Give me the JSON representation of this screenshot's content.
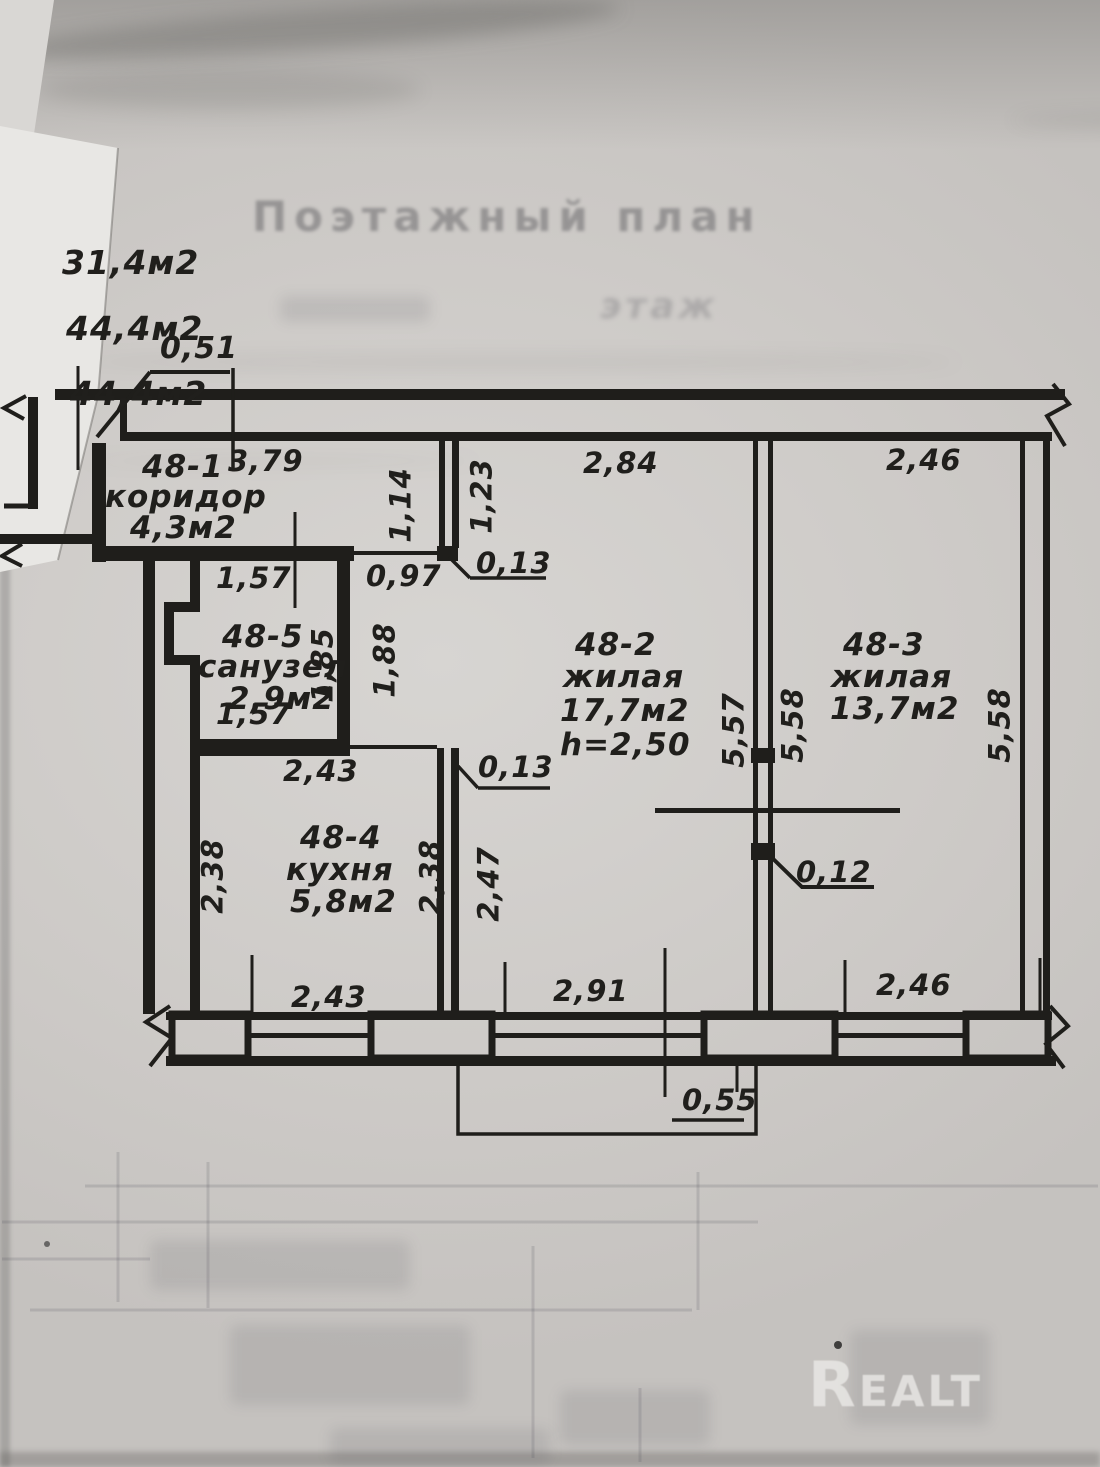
{
  "stamp": {
    "title": "Поэтажный план",
    "sub": "этаж"
  },
  "areas": {
    "a1": "31,4м2",
    "a2": "44,4м2",
    "a3": "44,4м2"
  },
  "rooms": {
    "r1": {
      "id": "48-1",
      "name": "коридор",
      "area": "4,3м2"
    },
    "r2": {
      "id": "48-2",
      "name": "жилая",
      "area": "17,7м2",
      "height": "h=2,50"
    },
    "r3": {
      "id": "48-3",
      "name": "жилая",
      "area": "13,7м2"
    },
    "r4": {
      "id": "48-4",
      "name": "кухня",
      "area": "5,8м2"
    },
    "r5": {
      "id": "48-5",
      "name": "санузел",
      "area": "2,9м2"
    }
  },
  "dims": {
    "entry_door": "0,51",
    "corridor_w": "3,79",
    "r2_top": "2,84",
    "r3_top": "2,46",
    "part1_left": "1,14",
    "part1_right": "1,23",
    "wc_top": "1,57",
    "corridor_opening": "0,97",
    "offset_top": "0,13",
    "wc_right": "1,85",
    "hall_h": "1,88",
    "wc_bottom": "1,57",
    "hall_w": "2,43",
    "offset_mid": "0,13",
    "r2_left_h": "5,57",
    "r2_right_h": "5,58",
    "r3_right_h": "5,58",
    "kitchen_left_h": "2,38",
    "kitchen_right_h": "2,38",
    "r2_lower_left_h": "2,47",
    "partition_t": "0,12",
    "kitchen_bottom": "2,43",
    "r2_bottom": "2,91",
    "r3_bottom": "2,46",
    "balcony_d": "0,55"
  },
  "watermark": "Realt"
}
